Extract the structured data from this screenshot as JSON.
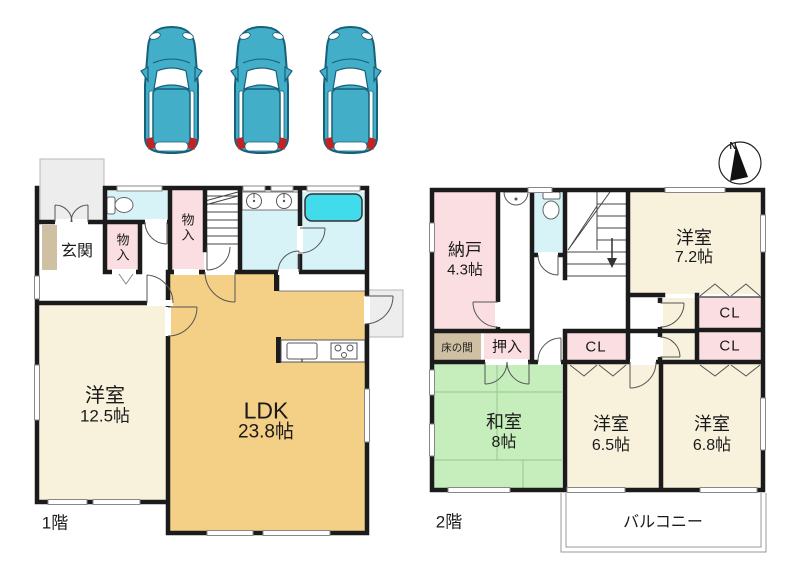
{
  "title": "2-story house floor plan with 3-car parking",
  "parking": {
    "car_count": 3
  },
  "compass": {
    "north": "N"
  },
  "floor1": {
    "label": "1階",
    "genkan": "玄関",
    "monoire_hall": "物入",
    "monoire_stairs": "物入",
    "youshitsu": {
      "name": "洋室",
      "size": "12.5帖"
    },
    "ldk": {
      "name": "LDK",
      "size": "23.8帖"
    }
  },
  "floor2": {
    "label": "2階",
    "nando": {
      "name": "納戸",
      "size": "4.3帖"
    },
    "tokonoma": "床の間",
    "oshiire": "押入",
    "cl_hall": "CL",
    "cl_upper": "CL",
    "cl_lower": "CL",
    "washitsu": {
      "name": "和室",
      "size": "8帖"
    },
    "youshitsu_72": {
      "name": "洋室",
      "size": "7.2帖"
    },
    "youshitsu_65": {
      "name": "洋室",
      "size": "6.5帖"
    },
    "youshitsu_68": {
      "name": "洋室",
      "size": "6.8帖"
    },
    "balcony": "バルコニー"
  },
  "colors": {
    "wall": "#1b1b1b",
    "room_pink": "#fbdee2",
    "room_cream": "#f8f1dc",
    "room_ldk_orange": "#f4cf86",
    "room_tatami_green": "#c6eebd",
    "wet_area_cyan": "#d8f3f7",
    "bathtub_cyan": "#41dbeb",
    "tokonoma_tan": "#cfc0a3",
    "porch_gray": "#ededed",
    "car_teal": "#43aec7",
    "taillight_red": "#c32222"
  }
}
